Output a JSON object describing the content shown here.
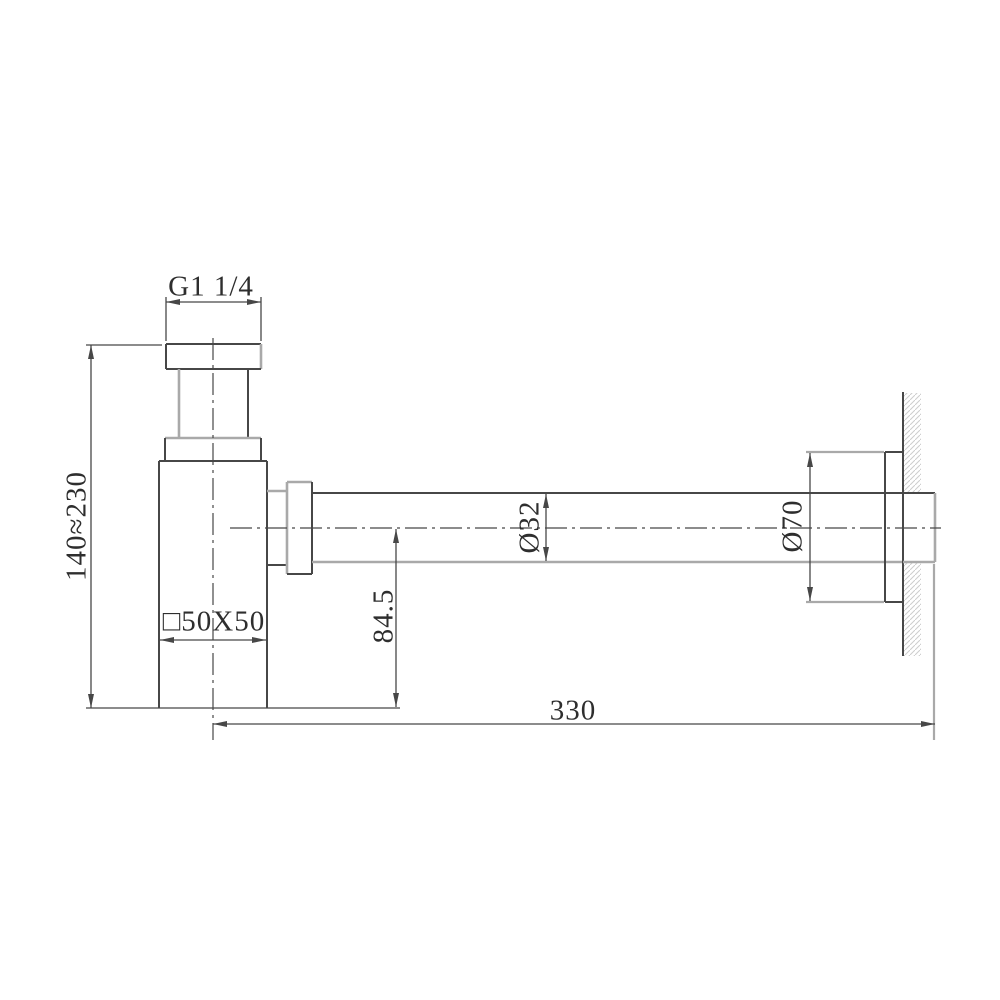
{
  "drawing": {
    "title": "bottle-trap-installation-drawing",
    "dimensions": {
      "thread": "G1 1/4",
      "height_range": "140≈230",
      "body_section": "□50X50",
      "outlet_drop": "84.5",
      "pipe_diameter": "Ø32",
      "flange_diameter": "Ø70",
      "wall_length": "330"
    },
    "colors": {
      "line_dark": "#474747",
      "line_gray": "#a9a9a9",
      "hatch": "#cccccc",
      "text": "#2e2e2e",
      "background": "#ffffff"
    }
  }
}
